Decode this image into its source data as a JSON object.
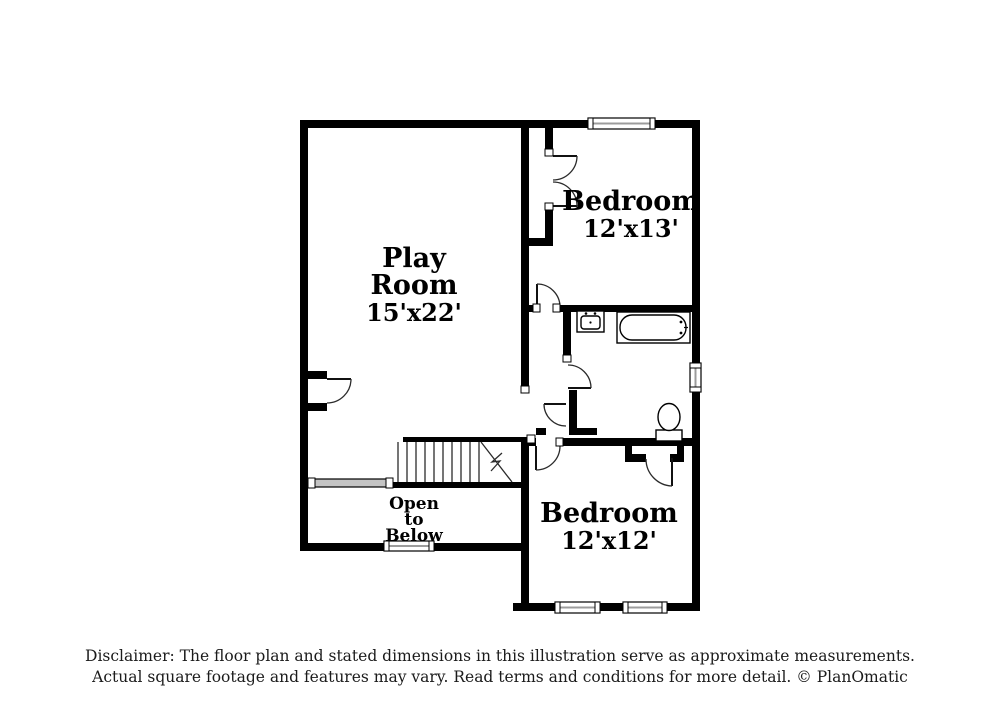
{
  "page": {
    "background": "#ffffff"
  },
  "colors": {
    "wall": "#000000",
    "door_line": "#2b2b2b",
    "glass_line": "#9c9c9c",
    "railing_fill": "#c4c4c4"
  },
  "rooms": {
    "play_room": {
      "line1": "Play",
      "line2": "Room",
      "dims": "15'x22'"
    },
    "bedroom_top": {
      "name": "Bedroom",
      "dims": "12'x13'"
    },
    "bedroom_bottom": {
      "name": "Bedroom",
      "dims": "12'x12'"
    },
    "open_below": {
      "line1": "Open",
      "line2": "to",
      "line3": "Below"
    }
  },
  "fixtures": [
    "stairs",
    "stair-railing",
    "bathtub",
    "sink",
    "toilet",
    "window",
    "door-swing"
  ],
  "disclaimer": {
    "line1": "Disclaimer: The floor plan and stated dimensions in this illustration serve as approximate measurements.",
    "line2": "Actual square footage and features may vary. Read terms and conditions for more detail. © PlanOmatic"
  }
}
